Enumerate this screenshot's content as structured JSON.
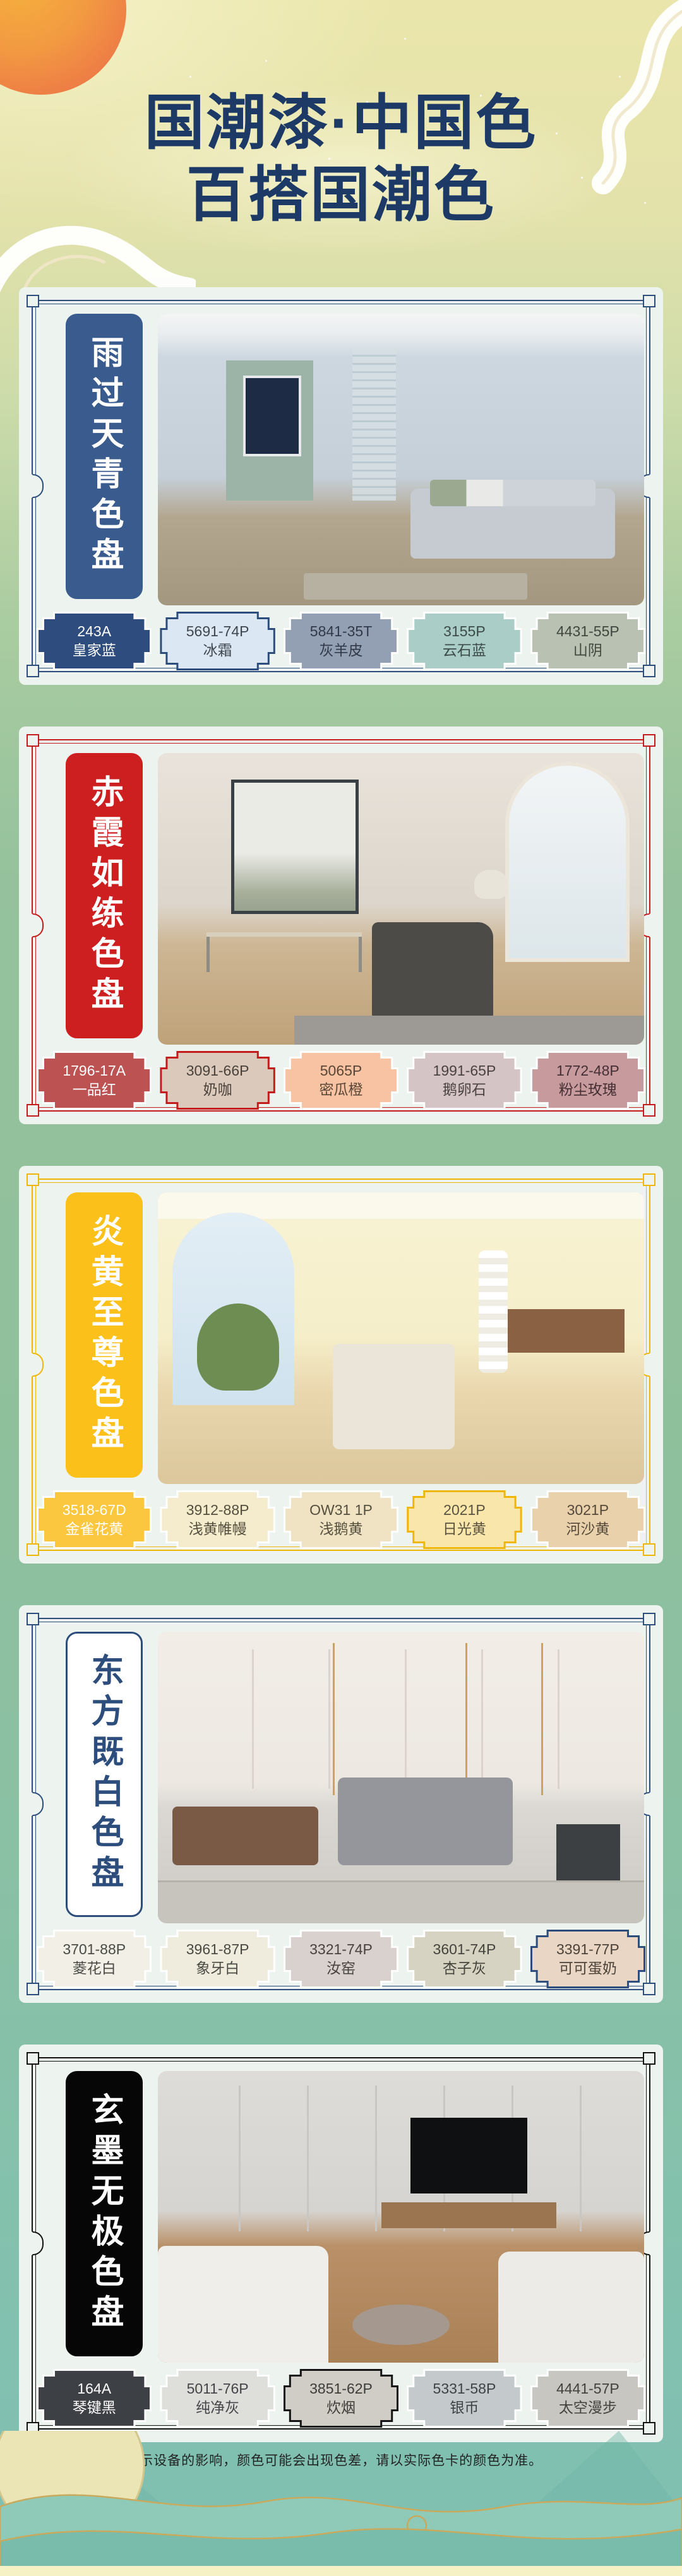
{
  "header": {
    "title_line1": "国潮漆·中国色",
    "title_line2": "百搭国潮色"
  },
  "footer": {
    "disclaimer": "*关于色差：因受显示设备的影响，颜色可能会出现色差，请以实际色卡的颜色为准。"
  },
  "panels": [
    {
      "title": "雨过天青色盘",
      "theme": {
        "frame": "#2d4d7d",
        "banner_bg": "#3a5b8d",
        "banner_text": "#ffffff",
        "banner_border": "#3a5b8d"
      },
      "swatches": [
        {
          "code": "243A",
          "name": "皇家蓝",
          "color": "#2e4d7e",
          "text_color": "#ffffff",
          "border": "#ffffff"
        },
        {
          "code": "5691-74P",
          "name": "冰霜",
          "color": "#dbe7f2",
          "text_color": "#3f4750",
          "border": "#2d4d7d"
        },
        {
          "code": "5841-35T",
          "name": "灰羊皮",
          "color": "#93a0b3",
          "text_color": "#30394a",
          "border": "#ffffff"
        },
        {
          "code": "3155P",
          "name": "云石蓝",
          "color": "#aacdc8",
          "text_color": "#3c4a48",
          "border": "#ffffff"
        },
        {
          "code": "4431-55P",
          "name": "山阴",
          "color": "#b9c1b3",
          "text_color": "#41463e",
          "border": "#ffffff"
        }
      ]
    },
    {
      "title": "赤霞如练色盘",
      "theme": {
        "frame": "#c41c1c",
        "banner_bg": "#cd1f1f",
        "banner_text": "#ffffff",
        "banner_border": "#cd1f1f"
      },
      "swatches": [
        {
          "code": "1796-17A",
          "name": "一品红",
          "color": "#bd5252",
          "text_color": "#ffffff",
          "border": "#ffffff"
        },
        {
          "code": "3091-66P",
          "name": "奶咖",
          "color": "#dbc9bb",
          "text_color": "#4a423a",
          "border": "#c41c1c"
        },
        {
          "code": "5065P",
          "name": "密瓜橙",
          "color": "#f7c3a2",
          "text_color": "#5a4636",
          "border": "#ffffff"
        },
        {
          "code": "1991-65P",
          "name": "鹅卵石",
          "color": "#d5c4c5",
          "text_color": "#4a4142",
          "border": "#ffffff"
        },
        {
          "code": "1772-48P",
          "name": "粉尘玫瑰",
          "color": "#c79a9e",
          "text_color": "#442f33",
          "border": "#ffffff"
        }
      ]
    },
    {
      "title": "炎黄至尊色盘",
      "theme": {
        "frame": "#f0b606",
        "banner_bg": "#fcc01a",
        "banner_text": "#ffffff",
        "banner_border": "#fcc01a"
      },
      "swatches": [
        {
          "code": "3518-67D",
          "name": "金雀花黄",
          "color": "#fbc73e",
          "text_color": "#ffffff",
          "border": "#ffffff"
        },
        {
          "code": "3912-88P",
          "name": "浅黄帷幔",
          "color": "#f5eccd",
          "text_color": "#55503e",
          "border": "#ffffff"
        },
        {
          "code": "OW31 1P",
          "name": "浅鹅黄",
          "color": "#f0e3c3",
          "text_color": "#55503e",
          "border": "#ffffff"
        },
        {
          "code": "2021P",
          "name": "日光黄",
          "color": "#f8e6ab",
          "text_color": "#5a5340",
          "border": "#f0b606"
        },
        {
          "code": "3021P",
          "name": "河沙黄",
          "color": "#e9d2ab",
          "text_color": "#57493a",
          "border": "#ffffff"
        }
      ]
    },
    {
      "title": "东方既白色盘",
      "theme": {
        "frame": "#2d4d7d",
        "banner_bg": "#ffffff",
        "banner_text": "#2d4d7d",
        "banner_border": "#2d4d7d"
      },
      "swatches": [
        {
          "code": "3701-88P",
          "name": "菱花白",
          "color": "#f2efe6",
          "text_color": "#4a4a44",
          "border": "#ffffff"
        },
        {
          "code": "3961-87P",
          "name": "象牙白",
          "color": "#efecdd",
          "text_color": "#4a4a42",
          "border": "#ffffff"
        },
        {
          "code": "3321-74P",
          "name": "汝窑",
          "color": "#d9d1cd",
          "text_color": "#48423f",
          "border": "#ffffff"
        },
        {
          "code": "3601-74P",
          "name": "杏子灰",
          "color": "#d7d3c3",
          "text_color": "#45443c",
          "border": "#ffffff"
        },
        {
          "code": "3391-77P",
          "name": "可可蛋奶",
          "color": "#e9d6c5",
          "text_color": "#4c4238",
          "border": "#2d4d7d"
        }
      ]
    },
    {
      "title": "玄墨无极色盘",
      "theme": {
        "frame": "#131313",
        "banner_bg": "#060606",
        "banner_text": "#ffffff",
        "banner_border": "#060606"
      },
      "swatches": [
        {
          "code": "164A",
          "name": "琴键黑",
          "color": "#3d4045",
          "text_color": "#ffffff",
          "border": "#ffffff"
        },
        {
          "code": "5011-76P",
          "name": "纯净灰",
          "color": "#dededb",
          "text_color": "#46464a",
          "border": "#ffffff"
        },
        {
          "code": "3851-62P",
          "name": "炊烟",
          "color": "#d0cdc7",
          "text_color": "#3e3c38",
          "border": "#141414"
        },
        {
          "code": "5331-58P",
          "name": "银币",
          "color": "#c4cacc",
          "text_color": "#3e4446",
          "border": "#ffffff"
        },
        {
          "code": "4441-57P",
          "name": "太空漫步",
          "color": "#c7c6c1",
          "text_color": "#43423d",
          "border": "#ffffff"
        }
      ]
    }
  ]
}
